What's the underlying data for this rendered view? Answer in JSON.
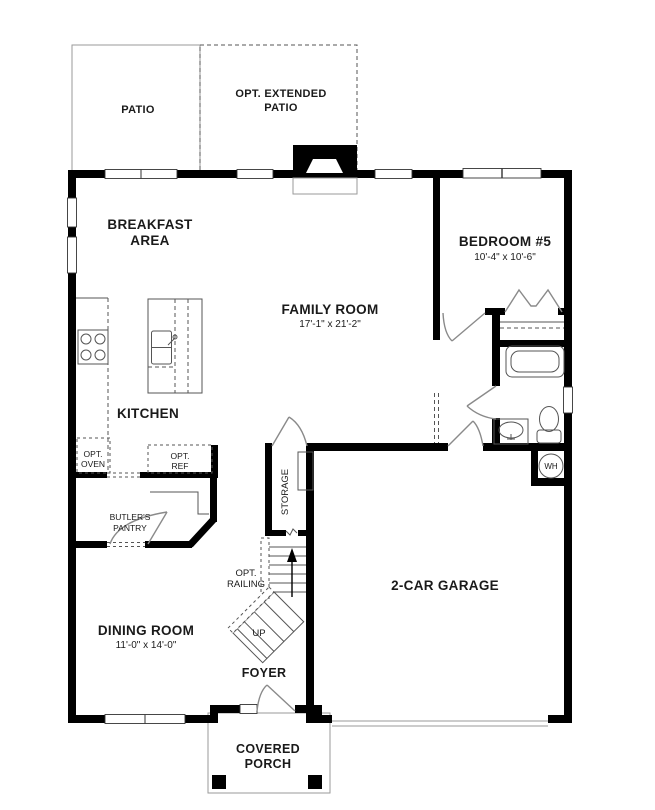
{
  "colors": {
    "wall": "#000000",
    "thin_line": "#555555",
    "light_line": "#9a9a9a",
    "door_line": "#8a8a8a",
    "text": "#1a1a1a",
    "background": "#ffffff"
  },
  "labels": {
    "patio": "PATIO",
    "opt_extended_patio": [
      "OPT. EXTENDED",
      "PATIO"
    ],
    "breakfast_area": [
      "BREAKFAST",
      "AREA"
    ],
    "family_room": {
      "name": "FAMILY ROOM",
      "dims": "17'-1\" x 21'-2\""
    },
    "bedroom5": {
      "name": "BEDROOM #5",
      "dims": "10'-4\" x 10'-6\""
    },
    "kitchen": "KITCHEN",
    "dining_room": {
      "name": "DINING ROOM",
      "dims": "11'-0\" x 14'-0\""
    },
    "garage": "2-CAR GARAGE",
    "foyer": "FOYER",
    "covered_porch": [
      "COVERED",
      "PORCH"
    ],
    "storage": "STORAGE",
    "opt_railing": [
      "OPT.",
      "RAILING"
    ],
    "up": "UP",
    "butlers_pantry": [
      "BUTLER'S",
      "PANTRY"
    ],
    "opt_oven": [
      "OPT.",
      "OVEN"
    ],
    "opt_ref": [
      "OPT.",
      "REF"
    ],
    "water_heater": "WH"
  }
}
